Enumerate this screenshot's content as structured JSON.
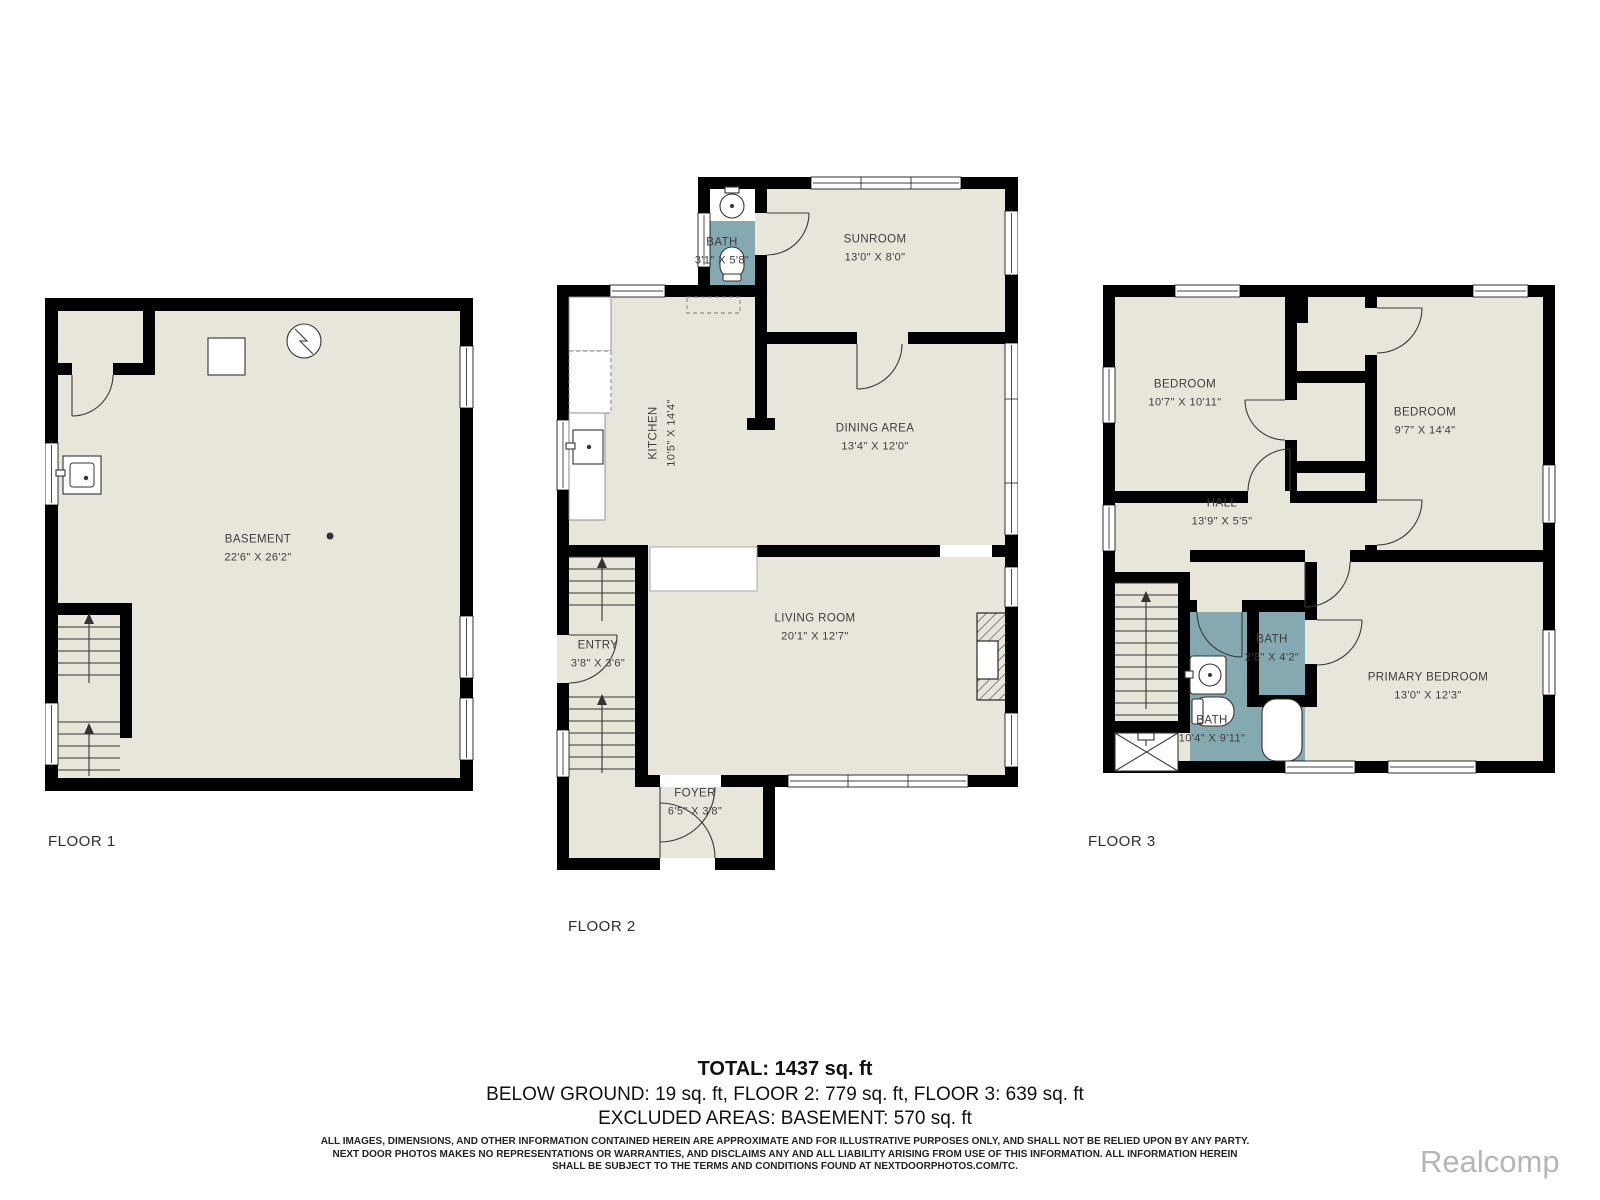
{
  "plan": {
    "floors": [
      {
        "label": "FLOOR 1",
        "rooms": [
          {
            "name": "BASEMENT",
            "dims": "22'6\" X 26'2\""
          }
        ]
      },
      {
        "label": "FLOOR 2",
        "rooms": [
          {
            "name": "BATH",
            "dims": "3'1\" X 5'8\""
          },
          {
            "name": "SUNROOM",
            "dims": "13'0\" X 8'0\""
          },
          {
            "name": "KITCHEN",
            "dims": "10'5\" X 14'4\""
          },
          {
            "name": "DINING AREA",
            "dims": "13'4\" X 12'0\""
          },
          {
            "name": "ENTRY",
            "dims": "3'8\" X 3'6\""
          },
          {
            "name": "LIVING ROOM",
            "dims": "20'1\" X 12'7\""
          },
          {
            "name": "FOYER",
            "dims": "6'5\" X 3'8\""
          }
        ]
      },
      {
        "label": "FLOOR 3",
        "rooms": [
          {
            "name": "BEDROOM",
            "dims": "10'7\" X 10'11\""
          },
          {
            "name": "BEDROOM",
            "dims": "9'7\" X 14'4\""
          },
          {
            "name": "HALL",
            "dims": "13'9\" X 5'5\""
          },
          {
            "name": "BATH",
            "dims": "2'8\" X 4'2\""
          },
          {
            "name": "BATH",
            "dims": "10'4\" X 9'11\""
          },
          {
            "name": "PRIMARY BEDROOM",
            "dims": "13'0\" X 12'3\""
          }
        ]
      }
    ]
  },
  "summary": {
    "total": "TOTAL: 1437 sq. ft",
    "breakdown": "BELOW GROUND: 19 sq. ft, FLOOR 2: 779 sq. ft, FLOOR 3: 639 sq. ft",
    "excluded": "EXCLUDED AREAS: BASEMENT: 570 sq. ft"
  },
  "disclaimer": {
    "line1": "ALL IMAGES, DIMENSIONS, AND OTHER INFORMATION CONTAINED HEREIN ARE APPROXIMATE AND FOR ILLUSTRATIVE PURPOSES ONLY, AND SHALL NOT BE RELIED UPON BY ANY PARTY.",
    "line2": "NEXT DOOR PHOTOS MAKES NO REPRESENTATIONS OR WARRANTIES, AND DISCLAIMS ANY AND ALL LIABILITY ARISING FROM USE OF THIS INFORMATION. ALL INFORMATION HEREIN",
    "line3": "SHALL BE SUBJECT TO THE TERMS AND CONDITIONS FOUND AT NEXTDOORPHOTOS.COM/TC."
  },
  "watermark": "Realcomp",
  "colors": {
    "floor_fill": "#e8e6da",
    "bath_fill": "#84a9b1",
    "wall": "#000000"
  }
}
